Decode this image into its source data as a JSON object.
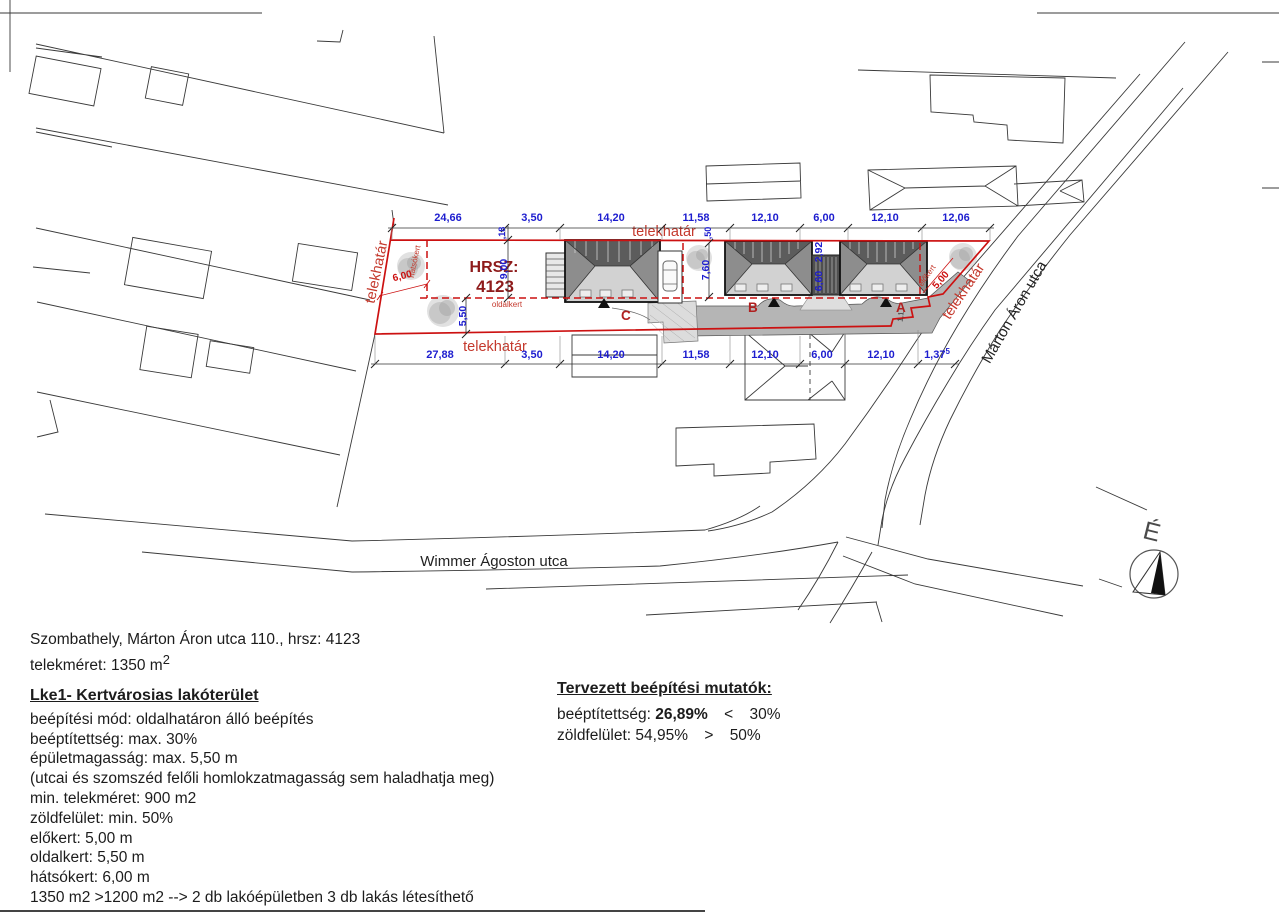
{
  "plan": {
    "hrsz_label": "HRSZ:",
    "hrsz_value": "4123",
    "labels": {
      "telekhatar_left": "telekhatár",
      "telekhatar_top": "telekhatár",
      "telekhatar_bottom": "telekhatár",
      "telekhatar_right": "telekhatár",
      "hatsokert": "hátsókert",
      "oldalkert": "oldalkert",
      "elokert": "előkert",
      "north": "É",
      "building_a": "A",
      "building_b": "B",
      "building_c": "C",
      "small_dim": "1,1"
    },
    "streets": {
      "wimmer": "Wimmer Ágoston utca",
      "marton": "Márton Áron utca"
    },
    "dims_top": [
      "24,66",
      "3,50",
      "14,20",
      "11,58",
      "12,10",
      "6,00",
      "12,10",
      "12,06"
    ],
    "dims_bottom": [
      "27,88",
      "3,50",
      "14,20",
      "11,58",
      "12,10",
      "6,00",
      "12,10"
    ],
    "dim_bottom_last": "1,37",
    "dim_bottom_last_sup": "5",
    "dims_vertical": {
      "v18": ",18",
      "v900": "9,00",
      "v550": "5,50",
      "v760": "7,60",
      "v50": ",50",
      "v292": "2,92",
      "v660": "6,60"
    },
    "dims_red": {
      "hatsokert": "6,00",
      "elokert": "5,00"
    }
  },
  "info": {
    "address": "Szombathely, Márton Áron utca 110., hrsz: 4123",
    "plot_size": "telekméret: 1350 m",
    "plot_size_sup": "2"
  },
  "zoning": {
    "heading": "Lke1- Kertvárosias lakóterület",
    "lines": [
      "beépítési mód: oldalhatáron álló beépítés",
      "beéptítettség: max. 30%",
      "épületmagasság: max. 5,50 m",
      "(utcai és szomszéd felőli homlokzatmagasság sem haladhatja meg)",
      "min. telekméret: 900 m2",
      "zöldfelület: min. 50%",
      "előkert: 5,00 m",
      "oldalkert: 5,50 m",
      "hátsókert: 6,00 m",
      "1350 m2 >1200 m2 --> 2 db lakóépületben 3 db lakás létesíthető"
    ]
  },
  "indicators": {
    "heading": "Tervezett beépítési mutatók:",
    "coverage_label": "beéptítettség:",
    "coverage_value": "26,89%",
    "coverage_op": "<",
    "coverage_limit": "30%",
    "green_label": "zöldfelület:",
    "green_value": "54,95%",
    "green_op": ">",
    "green_limit": "50%"
  },
  "colors": {
    "boundary_red": "#cc1111",
    "label_red": "#c4382c",
    "hrsz_maroon": "#8e1b1b",
    "dim_blue": "#1d1dcf",
    "driveway_gray": "#b5b5b5"
  }
}
